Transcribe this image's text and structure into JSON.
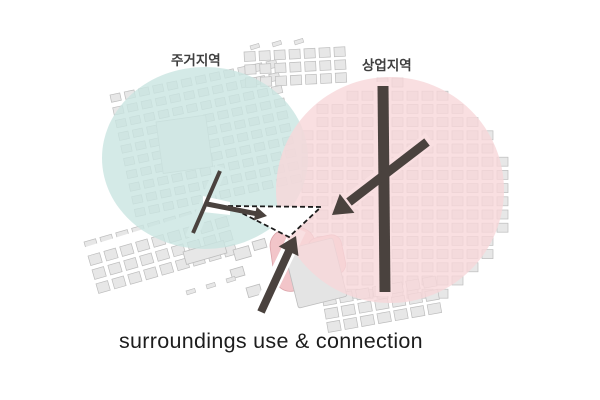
{
  "caption": "surroundings use & connection",
  "labels": {
    "residential": "주거지역",
    "commercial": "상업지역"
  },
  "colors": {
    "background": "#ffffff",
    "residential_zone": "#c9e5e1",
    "commercial_zone": "#f8d7da",
    "zone_opacity": "0.8",
    "building_fill": "#e7e7e7",
    "building_stroke": "#bdbdbd",
    "pink_building_fill": "#f2c5c9",
    "pink_building_stroke": "#dca3a9",
    "road": "#4a423e",
    "triangle_stroke": "#1c1c1c",
    "street": "#ffffff",
    "label_text": "#3f3f3f",
    "caption_text": "#1d1d1d"
  },
  "map": {
    "blocks": [
      {
        "name": "residential-grid",
        "ox": 110,
        "oy": 95,
        "rot": -12,
        "cols": 12,
        "rows": 10,
        "cw": 14.5,
        "ch": 13,
        "w": 10,
        "h": 7.5
      },
      {
        "name": "top-strip",
        "ox": 244,
        "oy": 52,
        "rot": -3,
        "cols": 7,
        "rows": 3,
        "cw": 15,
        "ch": 13,
        "w": 11,
        "h": 9.5
      },
      {
        "name": "commercial-grid",
        "ox": 302,
        "oy": 78,
        "rot": 0,
        "cols": 14,
        "rows": 17,
        "cw": 15,
        "ch": 13.2,
        "w": 11,
        "h": 9,
        "clip": {
          "cx": 390,
          "cy": 190,
          "rx": 112,
          "ry": 113
        }
      },
      {
        "name": "bottomleft-rows",
        "ox": 84,
        "oy": 242,
        "rot": -16,
        "cols": 9,
        "rows": 4,
        "cw": 16.5,
        "ch": 14.5,
        "w": 12,
        "h": 10
      },
      {
        "name": "bottomright-cluster",
        "ox": 322,
        "oy": 296,
        "rot": -10,
        "cols": 7,
        "rows": 3,
        "cw": 17,
        "ch": 13.5,
        "w": 13,
        "h": 10
      }
    ],
    "shapes": [
      {
        "name": "plaza",
        "x": 156,
        "y": 122,
        "w": 50,
        "h": 52,
        "rx": 0,
        "rot": -8,
        "fill": "#f0f0f0",
        "stroke": "#c6c6c6"
      },
      {
        "name": "pink-blob",
        "x": 268,
        "y": 232,
        "w": 45,
        "h": 62,
        "rx": 16,
        "rot": -8,
        "fill": "#f2c5c9",
        "stroke": "#dca3a9"
      },
      {
        "name": "pink-blob-2",
        "x": 306,
        "y": 240,
        "w": 34,
        "h": 40,
        "rx": 10,
        "rot": -12,
        "fill": "#f2c5c9",
        "stroke": "#dca3a9"
      },
      {
        "name": "big-block",
        "x": 284,
        "y": 250,
        "w": 50,
        "h": 60,
        "rx": 2,
        "rot": -14,
        "fill": "#e4e4e4",
        "stroke": "#bdbdbd"
      },
      {
        "name": "long-block",
        "x": 183,
        "y": 252,
        "w": 42,
        "h": 13,
        "rx": 0,
        "rot": -16,
        "fill": "#e7e7e7",
        "stroke": "#bdbdbd"
      },
      {
        "name": "mid-1",
        "x": 233,
        "y": 250,
        "w": 16,
        "h": 11,
        "rx": 0,
        "rot": -16,
        "fill": "#e7e7e7",
        "stroke": "#bdbdbd"
      },
      {
        "name": "mid-2",
        "x": 252,
        "y": 242,
        "w": 13,
        "h": 9,
        "rx": 0,
        "rot": -16,
        "fill": "#e7e7e7",
        "stroke": "#bdbdbd"
      },
      {
        "name": "mid-3",
        "x": 230,
        "y": 270,
        "w": 13,
        "h": 9,
        "rx": 0,
        "rot": -16,
        "fill": "#e7e7e7",
        "stroke": "#bdbdbd"
      },
      {
        "name": "mid-4",
        "x": 246,
        "y": 288,
        "w": 14,
        "h": 10,
        "rx": 0,
        "rot": -16,
        "fill": "#e7e7e7",
        "stroke": "#bdbdbd"
      }
    ],
    "streets": [
      {
        "x1": 78,
        "y1": 254,
        "x2": 252,
        "y2": 200,
        "w": 9
      },
      {
        "x1": 221,
        "y1": 167,
        "x2": 191,
        "y2": 238,
        "w": 12
      },
      {
        "x1": 383,
        "y1": 82,
        "x2": 384,
        "y2": 296,
        "w": 16
      },
      {
        "x1": 430,
        "y1": 139,
        "x2": 336,
        "y2": 211,
        "w": 15
      },
      {
        "x1": 257,
        "y1": 316,
        "x2": 299,
        "y2": 229,
        "w": 15
      }
    ],
    "street_dashes": [
      {
        "x": 186,
        "y": 291
      },
      {
        "x": 206,
        "y": 285
      },
      {
        "x": 226,
        "y": 279
      },
      {
        "x": 250,
        "y": 46
      },
      {
        "x": 272,
        "y": 43
      },
      {
        "x": 294,
        "y": 41
      }
    ]
  }
}
